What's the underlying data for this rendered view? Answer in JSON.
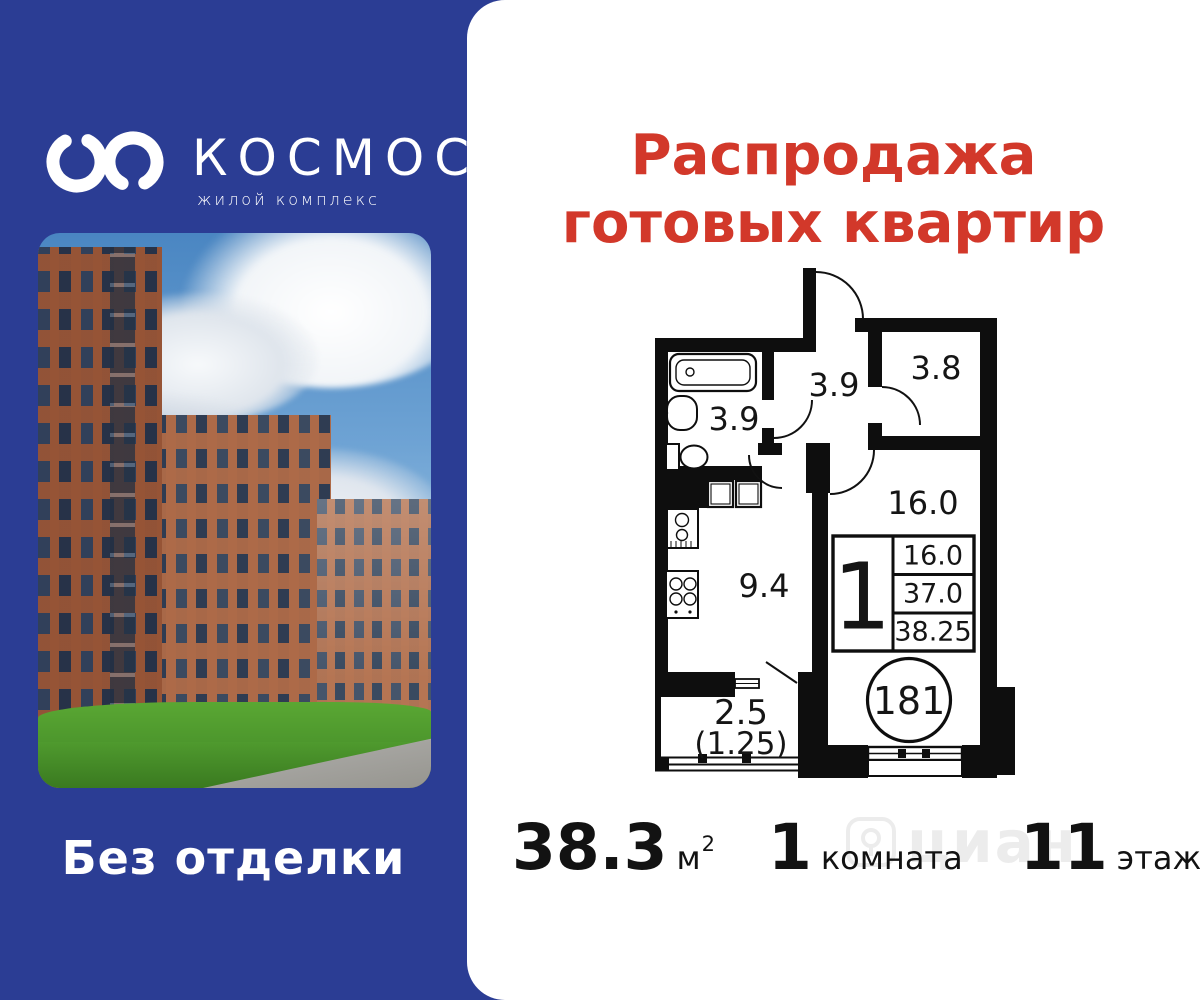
{
  "brand": {
    "name": "КОСМОС",
    "subtitle": "жилой комплекс",
    "tagline": "Без отделки"
  },
  "promo": {
    "title_line1": "Распродажа",
    "title_line2": "готовых квартир"
  },
  "floorplan": {
    "labels": {
      "bathroom": "3.9",
      "hallway": "3.9",
      "bedroom": "3.8",
      "living": "16.0",
      "kitchen": "9.4",
      "balcony": "2.5",
      "balcony_reduced": "(1.25)"
    },
    "info": {
      "rooms": "1",
      "living_area": "16.0",
      "area_no_balcony": "37.0",
      "total_area": "38.25"
    },
    "unit_number": "181"
  },
  "stats": {
    "area": {
      "value": "38.3",
      "unit": "м",
      "sup": "2"
    },
    "rooms": {
      "value": "1",
      "label": "комната"
    },
    "floor": {
      "value": "11",
      "label": "этаж"
    }
  },
  "watermark": {
    "text": "циан"
  },
  "colors": {
    "panel_blue": "#2b3d94",
    "accent_red": "#d2382a",
    "plan_black": "#0e0e0e"
  }
}
